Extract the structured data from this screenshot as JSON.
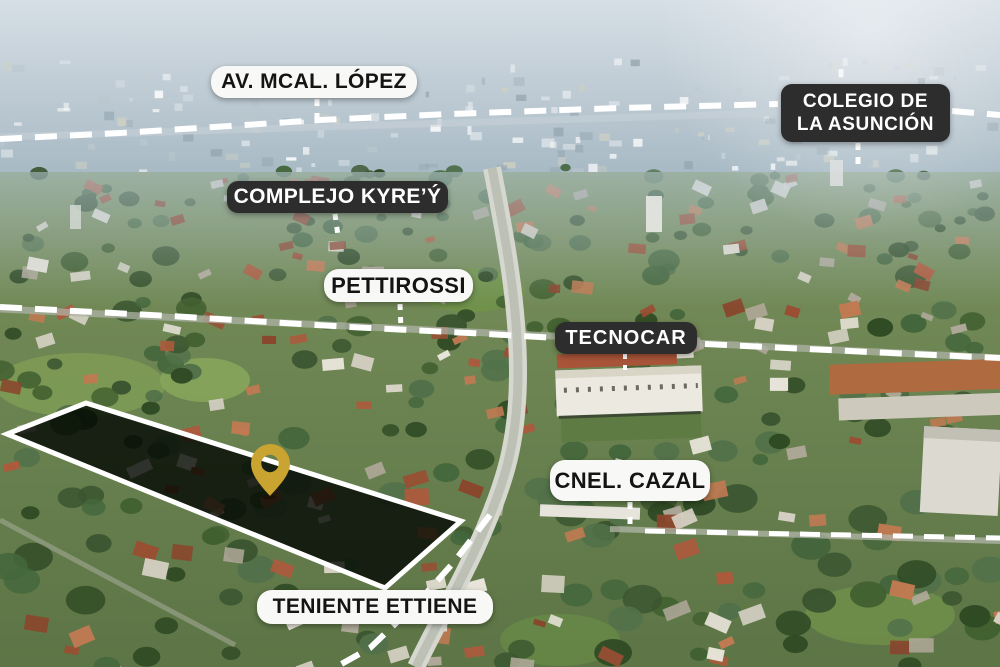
{
  "annotations": {
    "av_mcal_lopez": {
      "label": "AV. MCAL. LÓPEZ",
      "variant": "light"
    },
    "colegio_de_la_asuncion": {
      "line1": "COLEGIO DE",
      "line2": "LA ASUNCIÓN",
      "variant": "dark"
    },
    "complejo_kyrey": {
      "label": "COMPLEJO KYRE’Ý",
      "variant": "dark"
    },
    "pettirossi": {
      "label": "PETTIROSSI",
      "variant": "light"
    },
    "tecnocar": {
      "label": "TECNOCAR",
      "variant": "dark"
    },
    "cnel_cazal": {
      "label": "CNEL. CAZAL",
      "variant": "light"
    },
    "teniente_ettiene": {
      "label": "TENIENTE ETTIENE",
      "variant": "light"
    }
  },
  "markers": {
    "location_pin": {
      "icon": "map-pin-icon",
      "color": "#C9A431"
    }
  },
  "highlight": {
    "parcel_outline_color": "#FFFFFF",
    "parcel_fill": "rgba(2,8,2,0.8)"
  },
  "colors": {
    "label_light_bg": "#F8F8F6",
    "label_light_text": "#141414",
    "label_dark_bg": "#2D2D2D",
    "label_dark_text": "#FFFFFF",
    "dashed_road_line": "#FFFFFF"
  }
}
